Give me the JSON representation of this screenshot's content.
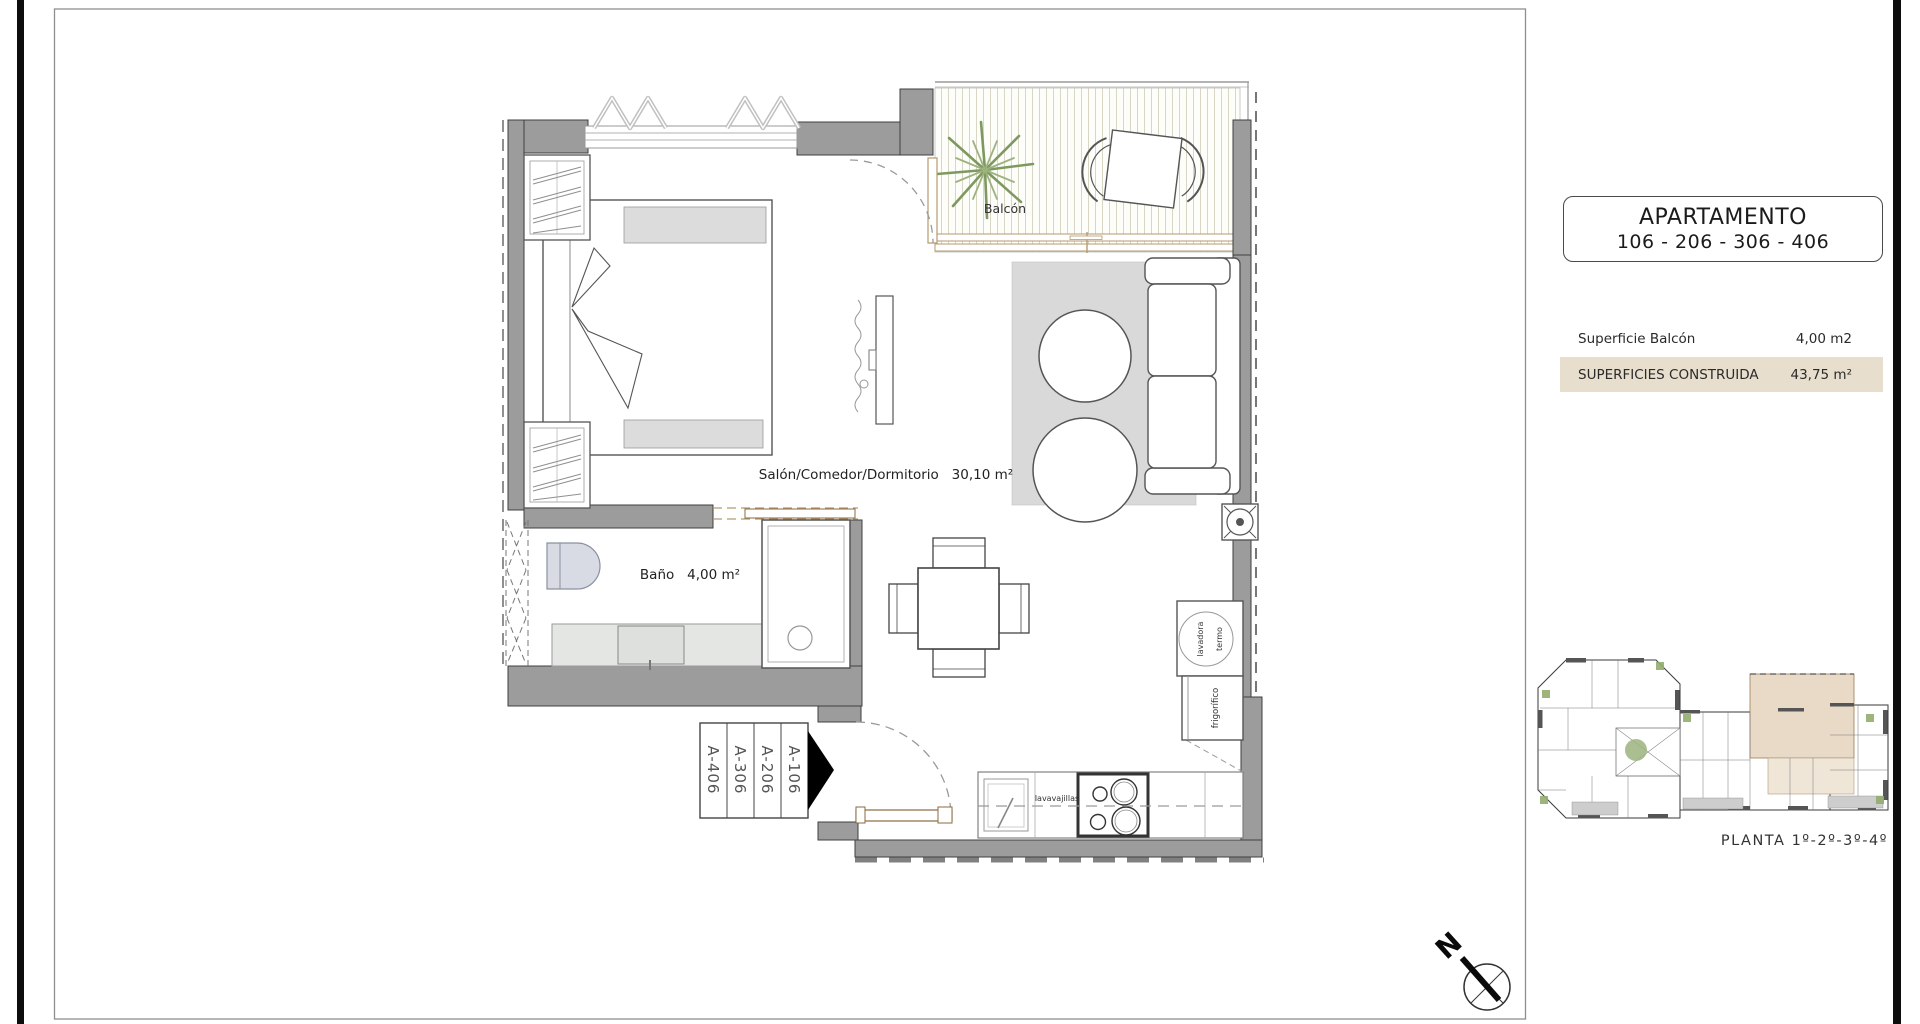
{
  "title_block": {
    "line1": "APARTAMENTO",
    "line2": "106 - 206 - 306 - 406"
  },
  "surface_table": {
    "rows": [
      {
        "label": "Superficie Balcón",
        "value": "4,00 m2",
        "highlighted": false
      },
      {
        "label": "SUPERFICIES CONSTRUIDA",
        "value": "43,75 m²",
        "highlighted": true
      }
    ],
    "highlight_color": "#e7decd"
  },
  "floor_plan": {
    "labels": {
      "living": "Salón/Comedor/Dormitorio   30,10 m²",
      "bathroom": "Baño   4,00 m²",
      "balcony": "Balcón",
      "dishwasher": "lavavajillas",
      "water_heater": "termo",
      "washer": "lavadora",
      "fridge": "frigorífico"
    },
    "unit_tags": [
      "A-406",
      "A-306",
      "A-206",
      "A-106"
    ]
  },
  "key_plan": {
    "caption": "PLANTA 1º-2º-3º-4º"
  },
  "compass": {
    "label": "N"
  },
  "colors": {
    "wall": "#9c9c9c",
    "wall_edge": "#3f3f3f",
    "highlight": "#e7decd",
    "plant": "#7e9960",
    "wood_frame": "#b59a6d",
    "key_plan_unit": "#e9dac7"
  }
}
